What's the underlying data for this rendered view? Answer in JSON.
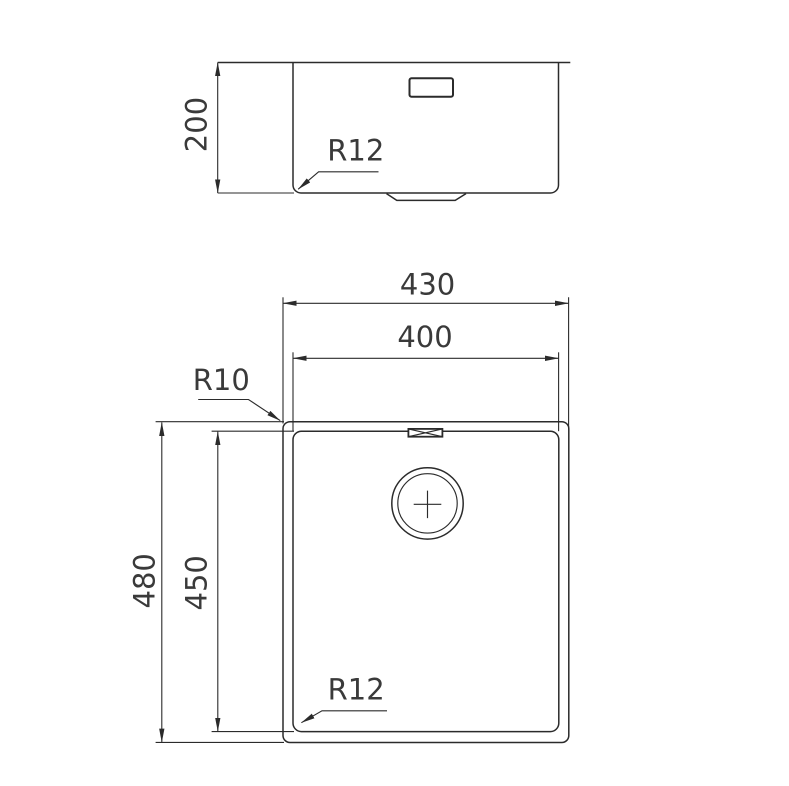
{
  "colors": {
    "line": "#2b2b2b",
    "text": "#3a3a3a",
    "background": "#ffffff"
  },
  "side_view": {
    "depth_label": "200",
    "corner_radius_label": "R12"
  },
  "plan_view": {
    "outer_width_label": "430",
    "bowl_width_label": "400",
    "outer_height_label": "480",
    "bowl_height_label": "450",
    "rim_corner_radius_label": "R10",
    "bowl_corner_radius_label": "R12"
  }
}
